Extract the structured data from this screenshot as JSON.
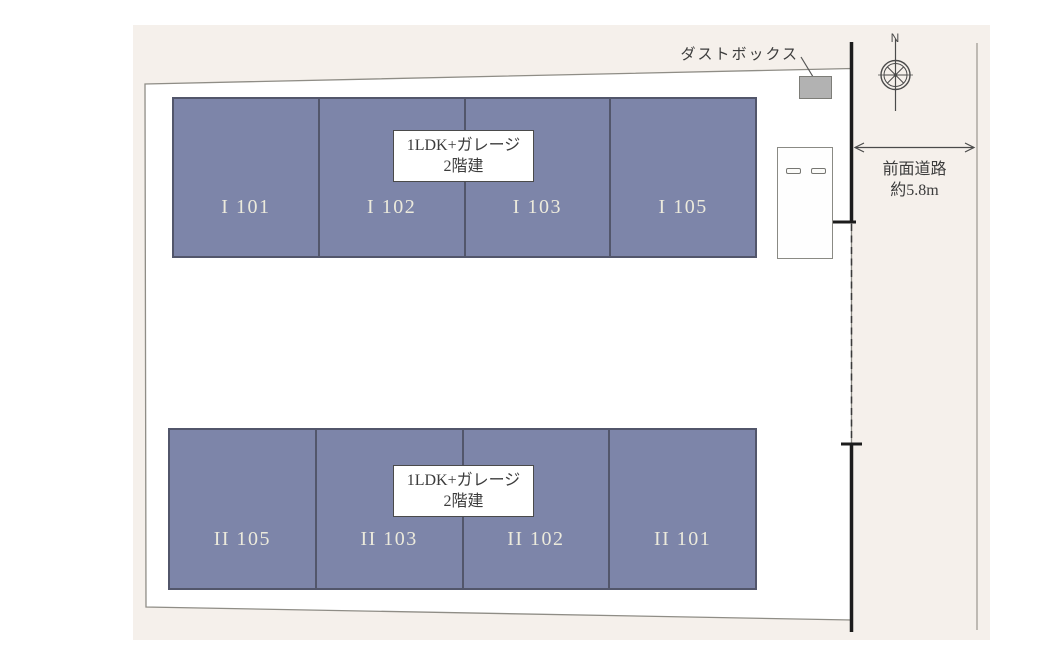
{
  "colors": {
    "canvas_bg": "#ffffff",
    "site_bg": "#f5f0eb",
    "plot_fill": "#ffffff",
    "plot_border": "#8f8d86",
    "unit_fill": "#7d85a9",
    "unit_border": "#52566b",
    "unit_text": "#eceadc",
    "road_line": "#1c1c1c",
    "text_dark": "#3c3c3c",
    "dustbox_fill": "#b2b2b2"
  },
  "buildings": {
    "row1": {
      "type_label_line1": "1LDK+ガレージ",
      "type_label_line2": "2階建",
      "units": [
        "I 101",
        "I 102",
        "I 103",
        "I 105"
      ]
    },
    "row2": {
      "type_label_line1": "1LDK+ガレージ",
      "type_label_line2": "2階建",
      "units": [
        "II 105",
        "II 103",
        "II 102",
        "II 101"
      ]
    }
  },
  "annotations": {
    "dustbox_label": "ダストボックス",
    "road_label_line1": "前面道路",
    "road_label_line2": "約5.8m",
    "compass_north": "N"
  }
}
